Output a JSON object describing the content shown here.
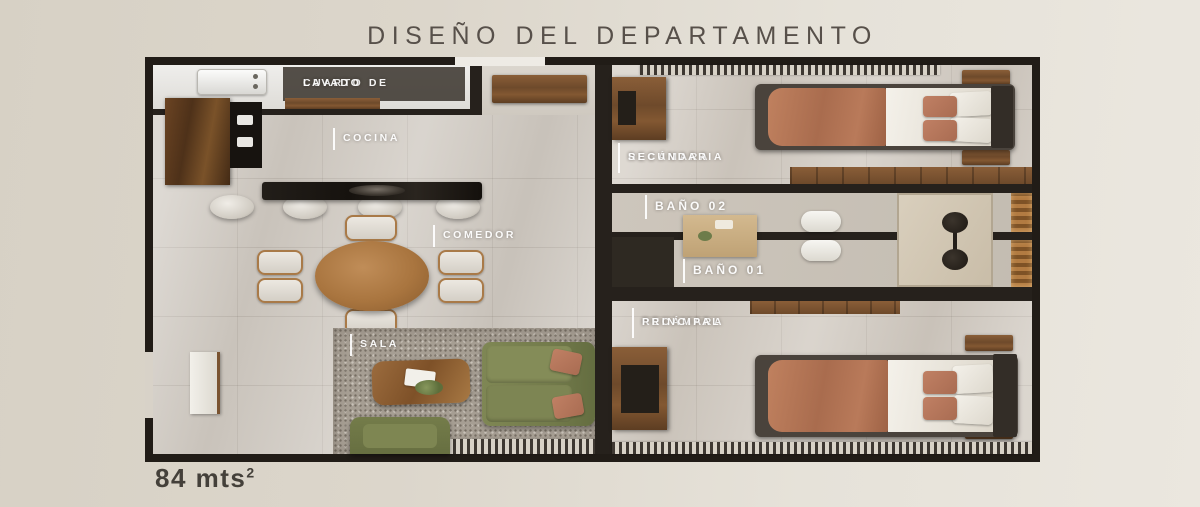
{
  "header": {
    "title": "DISEÑO DEL DEPARTAMENTO"
  },
  "footer": {
    "area": "84 mts",
    "area_exponent": "2"
  },
  "rooms": {
    "laundry": {
      "line1": "CUARTO DE",
      "line2": "LAVADO"
    },
    "kitchen": {
      "label": "COCINA"
    },
    "dining": {
      "label": "COMEDOR"
    },
    "living": {
      "label": "SALA"
    },
    "secondary_bedroom": {
      "line1": "RECÁMARA",
      "line2": "SECUNDARIA"
    },
    "bathroom_02": {
      "label": "BAÑO 02"
    },
    "bathroom_01": {
      "label": "BAÑO 01"
    },
    "main_bedroom": {
      "line1": "RECÁMARA",
      "line2": "PRINCIPAL"
    }
  },
  "colors": {
    "background": "#ddd8cd",
    "walls": "#26211c",
    "wood": "#7a5330",
    "floor": "#d0cac2",
    "sofa_green": "#7a8150",
    "bed_terracotta": "#b4755a",
    "label_text": "#ffffff",
    "title_text": "#57504a"
  }
}
